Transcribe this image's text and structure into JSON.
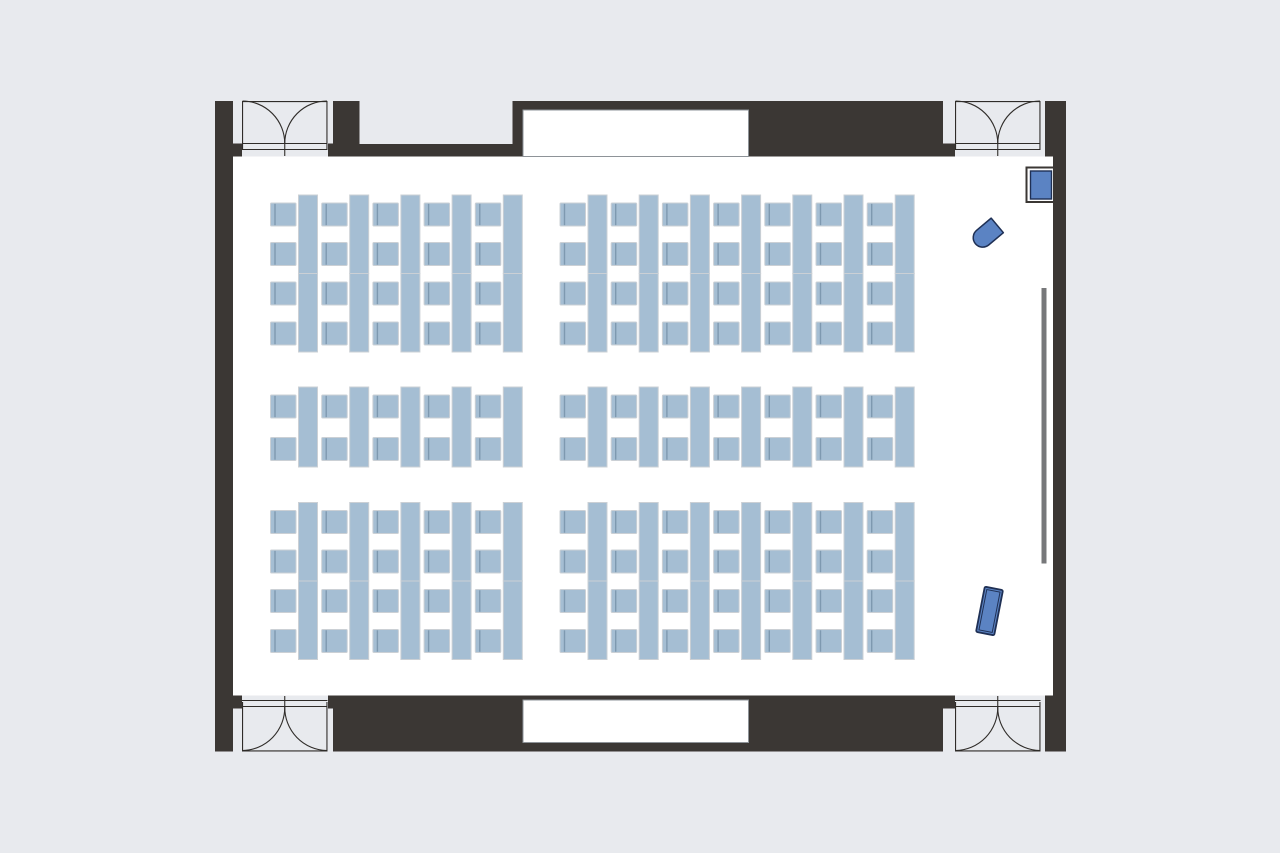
{
  "floorplan": {
    "canvas": {
      "width": 1280,
      "height": 853,
      "background": "#e8eaee"
    },
    "palette": {
      "wall": "#3b3734",
      "room_fill": "#ffffff",
      "door_line": "#2f2c29",
      "door_fill": "#e8eaee",
      "niche_border": "#8e9398",
      "furniture_fill": "#a5bed3",
      "furniture_border": "#cbd0d5",
      "chair_back": "#7e99b0",
      "accent_fill": "#5b83c3",
      "accent_border": "#1f3055",
      "screen_gray": "#77787a"
    },
    "room": {
      "outer": {
        "x": 215,
        "y": 101,
        "w": 851,
        "h": 650.5
      },
      "inner": {
        "x": 233,
        "y": 156.5,
        "w": 820,
        "h": 539
      }
    },
    "walls": [
      {
        "name": "left",
        "x": 215,
        "y": 101,
        "w": 18,
        "h": 650.5
      },
      {
        "name": "right",
        "x": 1053,
        "y": 101,
        "w": 13,
        "h": 650.5
      },
      {
        "name": "top-ledge-left",
        "x": 233,
        "y": 143.5,
        "w": 9,
        "h": 13
      },
      {
        "name": "top-ledge-door-right",
        "x": 328,
        "y": 143.5,
        "w": 5.5,
        "h": 13
      },
      {
        "name": "top-pillar-1",
        "x": 333,
        "y": 101,
        "w": 26.5,
        "h": 55.5
      },
      {
        "name": "top-ledge-mid",
        "x": 359.5,
        "y": 144,
        "w": 153.5,
        "h": 12.5
      },
      {
        "name": "top-pillar-2",
        "x": 512.5,
        "y": 101,
        "w": 11,
        "h": 55.5
      },
      {
        "name": "top-niche-header",
        "x": 523,
        "y": 101,
        "w": 225.5,
        "h": 10
      },
      {
        "name": "top-thick-right",
        "x": 748.5,
        "y": 101,
        "w": 194.5,
        "h": 55.5
      },
      {
        "name": "top-ledge-right",
        "x": 943,
        "y": 143.5,
        "w": 12,
        "h": 13
      },
      {
        "name": "top-corner-right",
        "x": 1045,
        "y": 101,
        "w": 21,
        "h": 55.5
      },
      {
        "name": "bottom-band",
        "x": 333,
        "y": 695.5,
        "w": 610,
        "h": 56
      },
      {
        "name": "bottom-ledge-left",
        "x": 233,
        "y": 695.5,
        "w": 9,
        "h": 13
      },
      {
        "name": "bottom-ledge-door-right",
        "x": 328,
        "y": 695.5,
        "w": 5.5,
        "h": 13
      },
      {
        "name": "bottom-ledge-right",
        "x": 943,
        "y": 695.5,
        "w": 12,
        "h": 13
      },
      {
        "name": "bottom-corner-right",
        "x": 1045,
        "y": 695.5,
        "w": 21,
        "h": 56
      }
    ],
    "niches": {
      "top": {
        "x": 523,
        "y": 110,
        "w": 225.5,
        "h": 46.5
      },
      "bottom": {
        "x": 523,
        "y": 700,
        "w": 225.5,
        "h": 42.5
      }
    },
    "door_geometry": {
      "width": 85.5,
      "arc_r": 42.5
    },
    "doors": [
      {
        "name": "top-left",
        "x": 242,
        "side": "top"
      },
      {
        "name": "top-right",
        "x": 955,
        "side": "top"
      },
      {
        "name": "bottom-left",
        "x": 242,
        "side": "bottom"
      },
      {
        "name": "bottom-right",
        "x": 955,
        "side": "bottom"
      }
    ],
    "seating_unit": {
      "pitch": 51.2,
      "chair_w": 25.5,
      "chair_h": 23,
      "desk_w": 19,
      "desk_dx": 28,
      "double_desk_h": 157,
      "single_desk_h": 80,
      "chair_offsets_double": [
        8,
        47.5,
        87,
        127
      ],
      "chair_offsets_single": [
        8,
        50.5
      ]
    },
    "seating_blocks": [
      {
        "name": "front-left",
        "x": 270.5,
        "y": 195,
        "cols": 5,
        "desk": "double"
      },
      {
        "name": "front-right",
        "x": 560,
        "y": 195,
        "cols": 7,
        "desk": "double"
      },
      {
        "name": "mid-left",
        "x": 270.5,
        "y": 387,
        "cols": 5,
        "desk": "single"
      },
      {
        "name": "mid-right",
        "x": 560,
        "y": 387,
        "cols": 7,
        "desk": "single"
      },
      {
        "name": "back-left",
        "x": 270.5,
        "y": 502.5,
        "cols": 5,
        "desk": "double"
      },
      {
        "name": "back-right",
        "x": 560,
        "y": 502.5,
        "cols": 7,
        "desk": "double"
      }
    ],
    "objects": {
      "screen_rail": {
        "x": 1041.5,
        "y": 288,
        "w": 5,
        "h": 275.5
      },
      "presenter_display": {
        "frame": {
          "x": 1026.5,
          "y": 167.5,
          "w": 27.5,
          "h": 34.5
        },
        "panel": {
          "x": 1030.5,
          "y": 171,
          "w": 21,
          "h": 28
        }
      },
      "presenter_chair": {
        "cx": 990,
        "cy": 231.5,
        "half": 9.5,
        "rotation": -40
      },
      "lectern": {
        "cx": 989.5,
        "cy": 611,
        "w": 18.5,
        "h": 46,
        "rotation": 11
      }
    }
  }
}
